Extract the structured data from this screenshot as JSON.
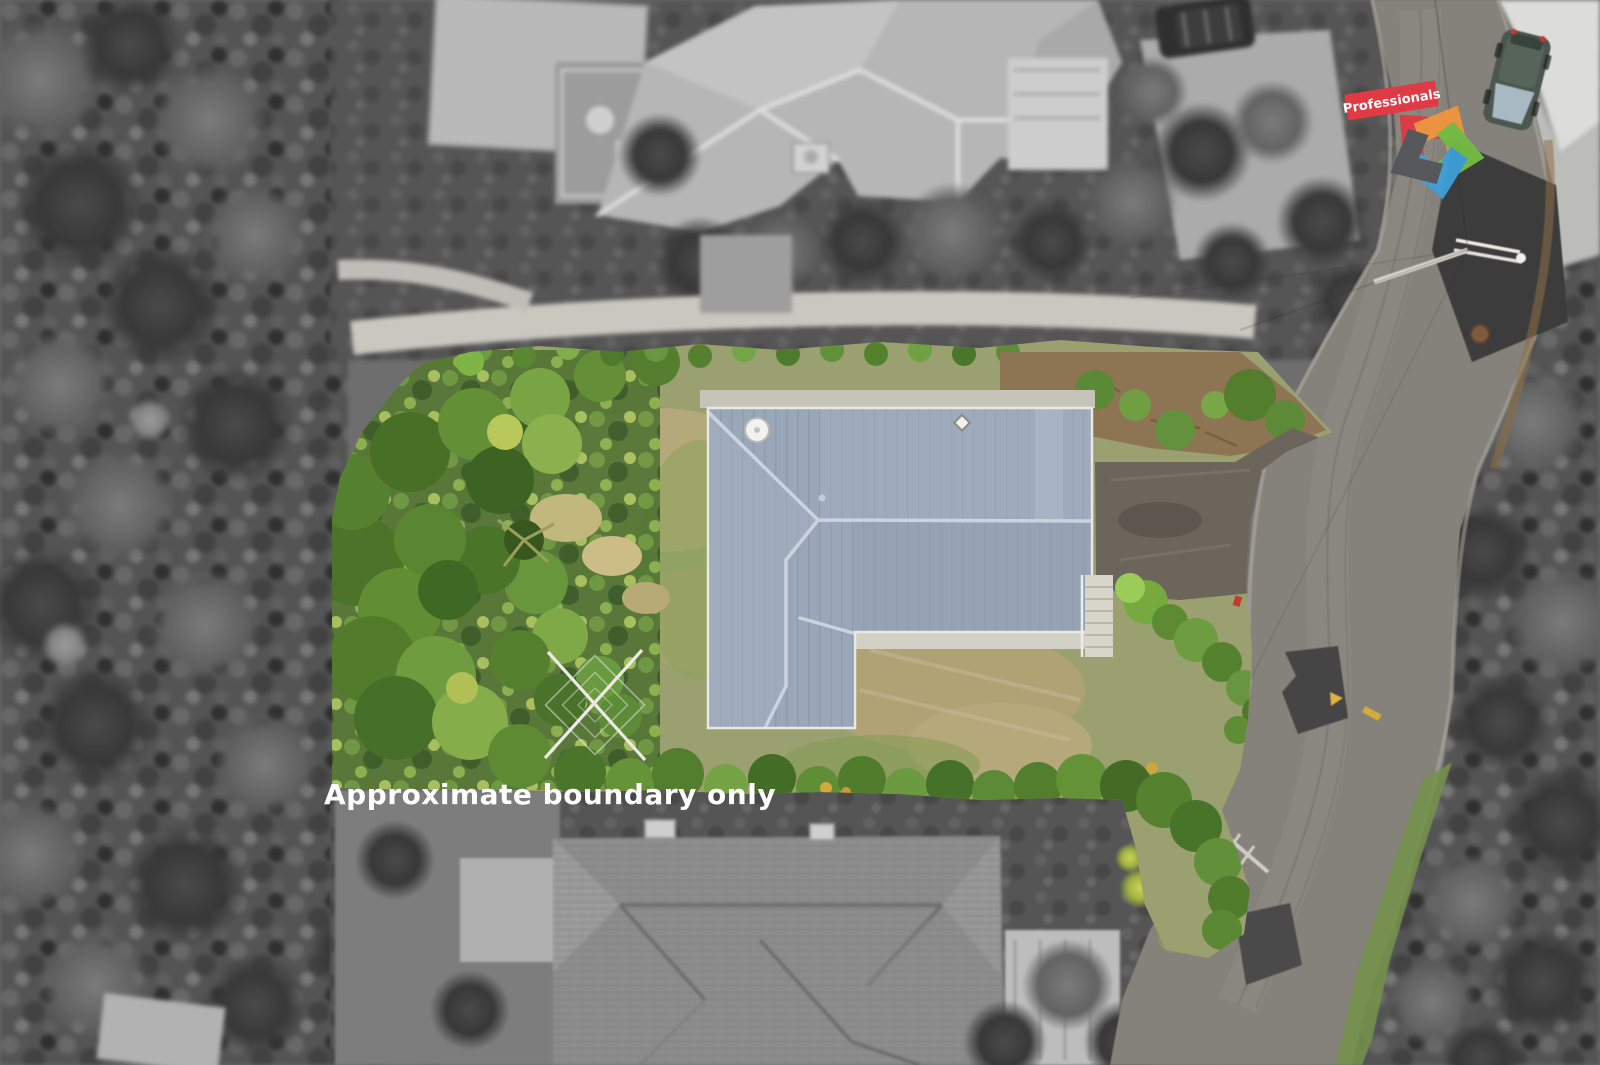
{
  "watermark": {
    "text": "Approximate boundary only",
    "color": "#ffffff"
  },
  "logo": {
    "brand_label": "Professionals",
    "banner_color": "#e03a45",
    "star_colors": {
      "red": "#e03a45",
      "orange": "#f2943e",
      "green": "#74bd44",
      "blue": "#3f9fd8",
      "gray": "#55565a"
    }
  },
  "palette": {
    "main_roof": "#9aa7b8",
    "roof_ridge": "#ccd3dc",
    "lawn": "#9aa06f",
    "dry_grass": "#b3a97b",
    "shrub_green": "#5d8a38",
    "road": "#85817b",
    "driveway_asphalt": "#6b655c",
    "concrete": "#c9c4b8",
    "road_patch": "#3f3f3f",
    "road_marking_yellow": "#ddb23f",
    "red_car": "#c0342c",
    "green_car": "#4a564e",
    "grayscale_forest": "#4c4c4c",
    "grayscale_house": "#b5b5b5"
  }
}
